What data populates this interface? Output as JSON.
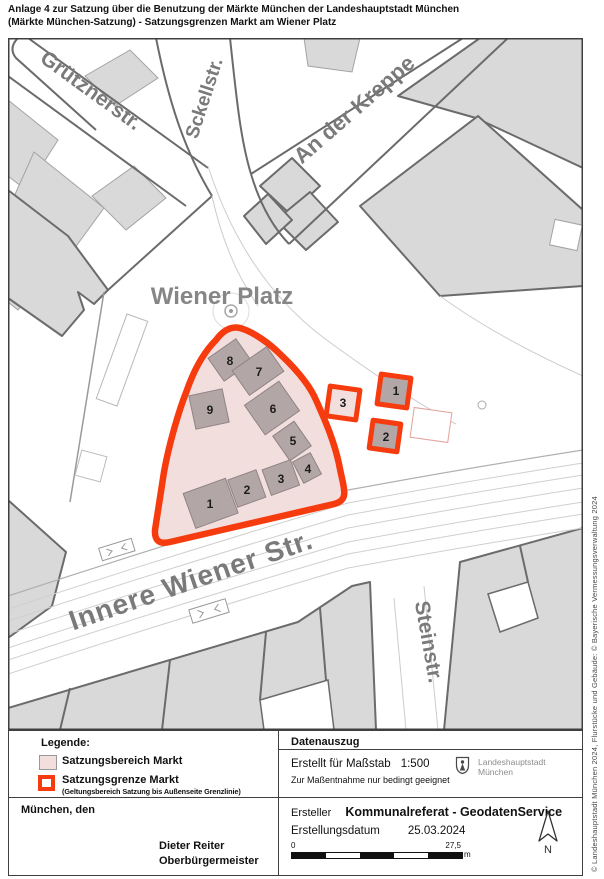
{
  "page": {
    "title_line1": "Anlage 4 zur Satzung über die Benutzung der Märkte München der Landeshauptstadt München",
    "title_line2": "(Märkte München-Satzung) - Satzungsgrenzen Markt am Wiener Platz"
  },
  "map": {
    "street_labels": {
      "gruetznerstr": "Grütznerstr.",
      "sckellstr": "Sckellstr.",
      "an_der_kreppe": "An der Kreppe",
      "wiener_platz": "Wiener Platz",
      "innere_wiener_str": "Innere Wiener Str.",
      "steinstr": "Steinstr."
    },
    "market_numbers": [
      "1",
      "2",
      "3",
      "4",
      "5",
      "6",
      "7",
      "8",
      "9"
    ],
    "stand_numbers": [
      "1",
      "2",
      "3"
    ],
    "colors": {
      "market_fill": "#f3dede",
      "market_border": "#f63b0e",
      "market_building_fill": "#b3a6a6",
      "parcel_fill": "#d9d9d9"
    }
  },
  "legend": {
    "heading": "Legende:",
    "area_item": "Satzungsbereich Markt",
    "border_item": "Satzungsgrenze Markt",
    "border_item_note": "(Geltungsbereich Satzung bis Außenseite Grenzlinie)",
    "place_date_line": "München, den",
    "signer_name": "Dieter Reiter",
    "signer_title": "Oberbürgermeister"
  },
  "data_extract": {
    "heading": "Datenauszug",
    "scale_label": "Erstellt für Maßstab",
    "scale_value": "1:500",
    "scale_note": "Zur Maßentnahme nur bedingt geeignet",
    "city_coat_line1": "Landeshauptstadt",
    "city_coat_line2": "München",
    "creator_label": "Ersteller",
    "creator_value": "Kommunalreferat - GeodatenService",
    "date_label": "Erstellungsdatum",
    "date_value": "25.03.2024",
    "scalebar_start": "0",
    "scalebar_end": "27,5",
    "scalebar_unit": "m",
    "north_label": "N"
  },
  "footer_note": "© Landeshauptstadt München 2024, Flurstücke und Gebäude: © Bayerische Vermessungsverwaltung 2024"
}
